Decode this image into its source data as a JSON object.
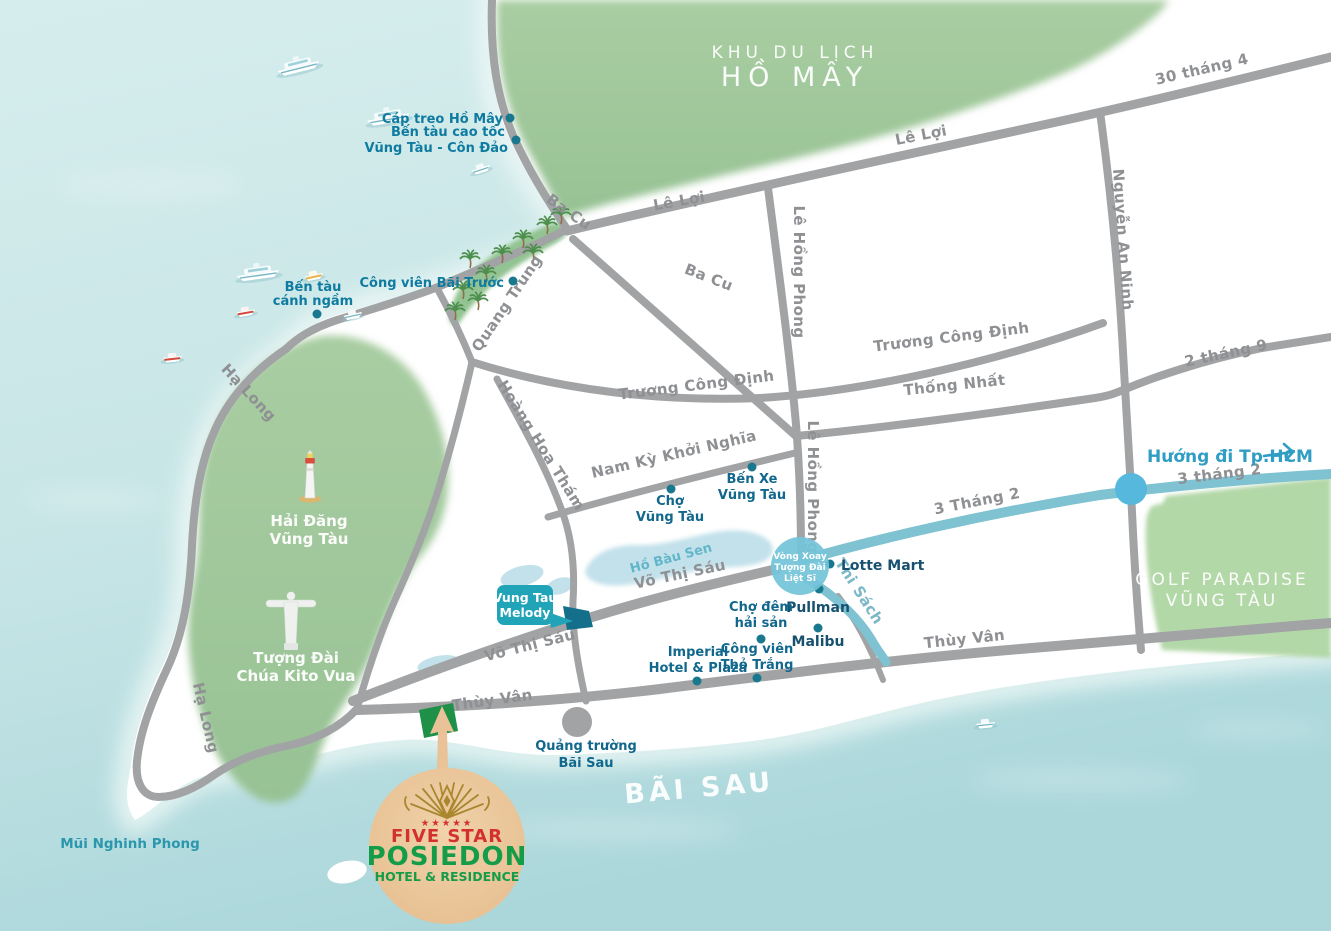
{
  "areas": {
    "khu_du_lich_line1": "KHU DU LỊCH",
    "khu_du_lich_line2": "HỒ MÂY",
    "golf_line1": "GOLF PARADISE",
    "golf_line2": "VŨNG TÀU",
    "bai_sau": "BÃI SAU",
    "mui_nghinh_phong": "Mũi Nghinh Phong",
    "ho_bau_sen": "Hồ Bàu Sen",
    "huong_di_hcm": "Hướng đi Tp.HCM"
  },
  "roads": {
    "ba_cu_1": "Ba Cu",
    "ba_cu_2": "Ba Cu",
    "le_loi_1": "Lê Lợi",
    "le_loi_2": "Lê Lợi",
    "thang4_30": "30 tháng 4",
    "nguyen_an_ninh": "Nguyễn An Ninh",
    "truong_cong_dinh_1": "Trương Công Định",
    "truong_cong_dinh_2": "Trương Công Định",
    "thong_nhat": "Thống Nhất",
    "thang9_2": "2 tháng 9",
    "le_hong_phong_1": "Lê Hồng Phong",
    "le_hong_phong_2": "Lê Hồng Phong",
    "quang_trung": "Quang Trung",
    "hoang_hoa_tham": "Hoàng Hoa Thám",
    "nam_ky_khoi_nghia": "Nam Kỳ Khởi Nghĩa",
    "vo_thi_sau_1": "Võ Thị Sáu",
    "vo_thi_sau_2": "Võ Thị Sáu",
    "thuy_van_1": "Thùy Vân",
    "thuy_van_2": "Thùy Vân",
    "ha_long_1": "Hạ Long",
    "ha_long_2": "Hạ Long",
    "thang2_3_1": "3 Tháng 2",
    "thang2_3_2": "3 tháng 2",
    "thi_sach": "Thi Sách"
  },
  "pois": {
    "cap_treo": "Cáp treo Hồ Mây",
    "ben_tau_cao_toc_line1": "Bến tàu cao tốc",
    "ben_tau_cao_toc_line2": "Vũng Tàu - Côn Đảo",
    "cong_vien_bai_truoc": "Công viên Bãi Trước",
    "ben_tau_canh_ngam_line1": "Bến tàu",
    "ben_tau_canh_ngam_line2": "cánh ngầm",
    "cho_vung_tau_line1": "Chợ",
    "cho_vung_tau_line2": "Vũng Tàu",
    "ben_xe_line1": "Bến Xe",
    "ben_xe_line2": "Vũng Tàu",
    "lotte_mart": "Lotte Mart",
    "pullman": "Pullman",
    "malibu": "Malibu",
    "cho_dem_line1": "Chợ đêm",
    "cho_dem_line2": "hải sản",
    "cong_vien_tho_trang_line1": "Công viên",
    "cong_vien_tho_trang_line2": "Thỏ Trắng",
    "imperial_line1": "Imperial",
    "imperial_line2": "Hotel & Plaza",
    "quang_truong_line1": "Quảng trường",
    "quang_truong_line2": "Bãi Sau"
  },
  "landmarks": {
    "hai_dang_line1": "Hải Đăng",
    "hai_dang_line2": "Vũng Tàu",
    "tuong_dai_line1": "Tượng Đài",
    "tuong_dai_line2": "Chúa Kito Vua",
    "vong_xoay_line1": "Vòng Xoay",
    "vong_xoay_line2": "Tượng Đài",
    "vong_xoay_line3": "Liệt Sĩ",
    "melody_line1": "Vung Tau",
    "melody_line2": "Melody"
  },
  "logo": {
    "stars": "★★★★★",
    "five_star": "FIVE STAR",
    "brand": "POSIEDON",
    "tagline": "HOTEL & RESIDENCE"
  },
  "colors": {
    "sea": "#cde8e8",
    "land": "#ffffff",
    "forest": "#a2c89d",
    "golf_green": "#b3d8a8",
    "road_gray": "#a1a3a5",
    "road_teal": "#7fc2d2",
    "poi_dot": "#19788e",
    "poi_text": "#12688c",
    "roundabout_blue": "#55b8dc",
    "vong_xoay_circle": "#74c4d9",
    "melody_box": "#21a3b8",
    "hotel_site_green": "#1e9048",
    "logo_circle": "#ecc69b",
    "logo_red": "#d2312d",
    "logo_green": "#159c49",
    "logo_gold": "#a8872f"
  }
}
